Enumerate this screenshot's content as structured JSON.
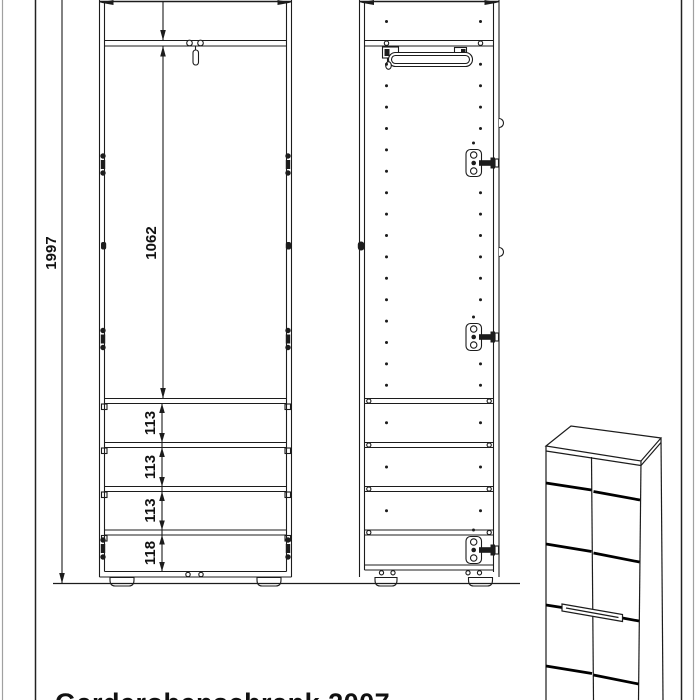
{
  "page": {
    "caption": "Garderobenschrank 2007",
    "colors": {
      "line": "#1c1c1c",
      "frame_dark": "#222222",
      "frame_light": "#a0a0a0",
      "background": "#ffffff"
    }
  },
  "dimensions": {
    "total_height": "1997",
    "upper_compartment_height": "1062",
    "shelf_gap_1": "113",
    "shelf_gap_2": "113",
    "shelf_gap_3": "113",
    "shelf_gap_bottom": "118"
  }
}
